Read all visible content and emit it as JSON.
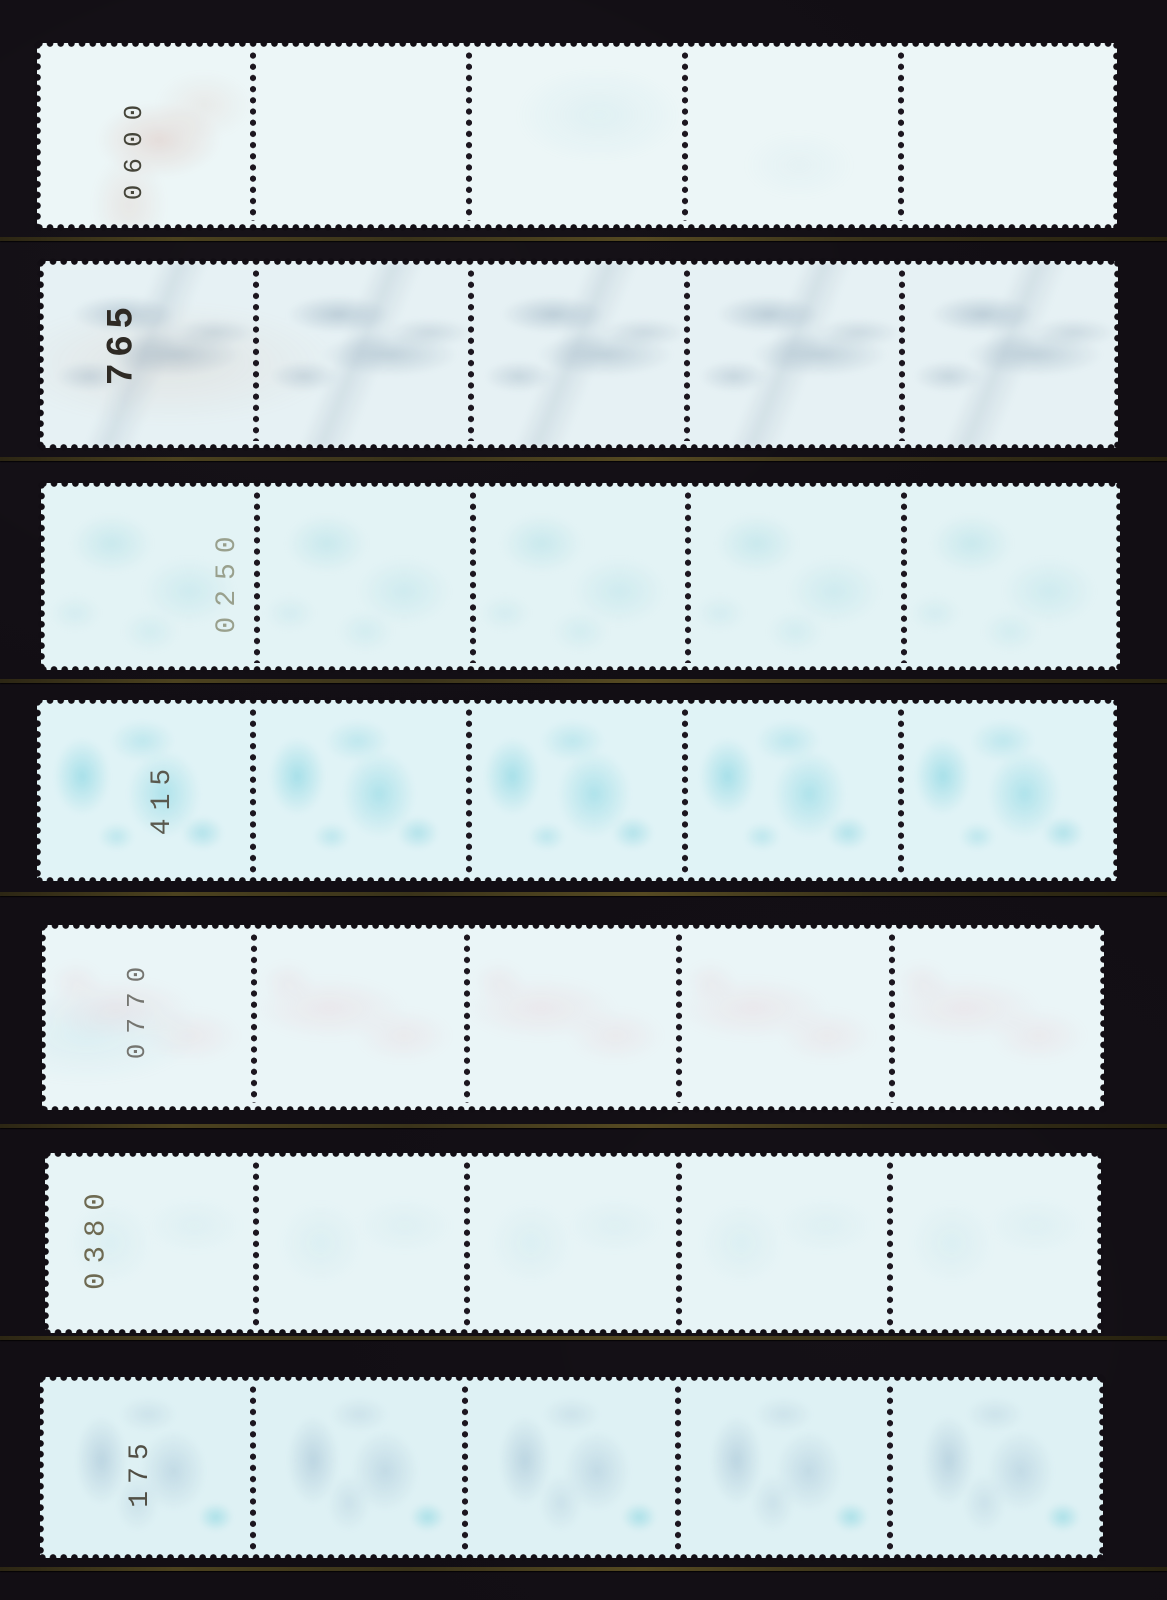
{
  "scene": {
    "description": "Seven horizontal coil-stamp strips of five stamps each, shown gum side up with rotated roll counting numbers, mounted on a black stockbook page",
    "background_color": "#120e14",
    "paper_color": "#e6f3f6",
    "perforation_hole_color": "#1c161f",
    "mount_edge_color": "#4f4526",
    "stamps_per_strip": 5,
    "strip_count": 7
  },
  "strips": [
    {
      "position": 1,
      "number": "0600",
      "css": {
        "color": "#45453a"
      },
      "showthrough_color": "#c97a68",
      "showthrough": "faint red-brown smudge near number, mostly blank back"
    },
    {
      "position": 2,
      "number": "765",
      "css": {
        "color": "#2e2a24"
      },
      "showthrough_color": "#7a96ac",
      "showthrough": "clear gray-blue mirrored design on every stamp with warm speckles"
    },
    {
      "position": 3,
      "number": "0250",
      "css": {
        "color": "#99a08d"
      },
      "showthrough_color": "#8ed2dc",
      "showthrough": "soft cyan cloudy design show-through"
    },
    {
      "position": 4,
      "number": "415",
      "css": {
        "color": "#5a594e"
      },
      "showthrough_color": "#6ecddc",
      "showthrough": "strong cyan mirrored design on every stamp"
    },
    {
      "position": 5,
      "number": "0770",
      "css": {
        "color": "#757570"
      },
      "showthrough_color": "#eba8b6",
      "showthrough": "very faint pink-red speckled show-through"
    },
    {
      "position": 6,
      "number": "0380",
      "css": {
        "color": "#6e6a52"
      },
      "showthrough_color": "#96d4de",
      "showthrough": "almost blank, barely visible cyan traces"
    },
    {
      "position": 7,
      "number": "175",
      "css": {
        "color": "#514f45"
      },
      "showthrough_color": "#8aacc6",
      "showthrough": "blue-gray mirrored shapes with small cyan numeral mark per stamp"
    }
  ]
}
